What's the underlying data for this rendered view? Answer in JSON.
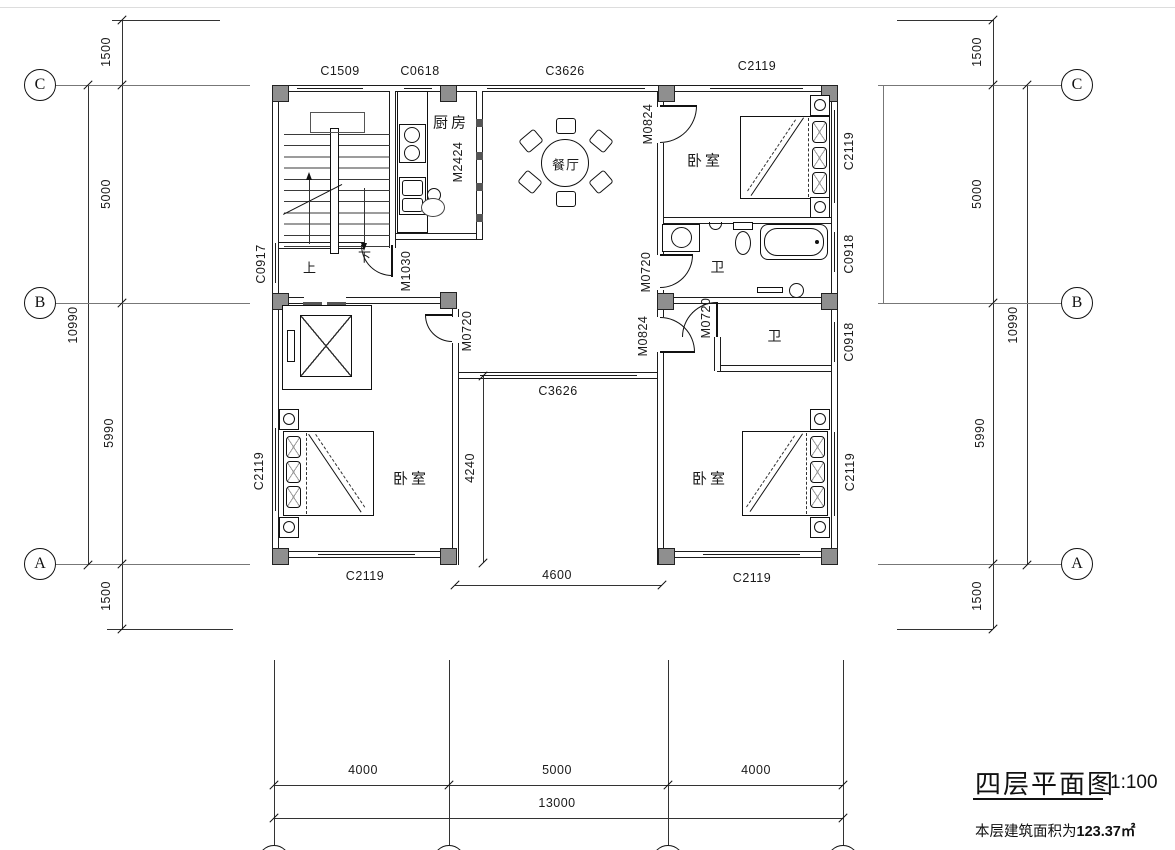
{
  "drawing": {
    "title": "四层平面图",
    "scale": "1:100",
    "area_label": "本层建筑面积为",
    "area_value": "123.37㎡"
  },
  "grid_bubbles": {
    "a": "A",
    "b": "B",
    "c": "C"
  },
  "dims": {
    "d1500": "1500",
    "d5000": "5000",
    "d5990": "5990",
    "d10990": "10990",
    "d4000": "4000",
    "d13000": "13000",
    "d4240": "4240",
    "d4600": "4600"
  },
  "openings": {
    "c1509": "C1509",
    "c0618": "C0618",
    "c3626": "C3626",
    "c2119": "C2119",
    "c0917": "C0917",
    "c0918": "C0918",
    "m2424": "M2424",
    "m1030": "M1030",
    "m0824": "M0824",
    "m0720": "M0720"
  },
  "rooms": {
    "kitchen": "厨房",
    "dining": "餐厅",
    "bedroom": "卧室",
    "bath": "卫"
  },
  "stairs": {
    "up": "上",
    "down": "下"
  }
}
